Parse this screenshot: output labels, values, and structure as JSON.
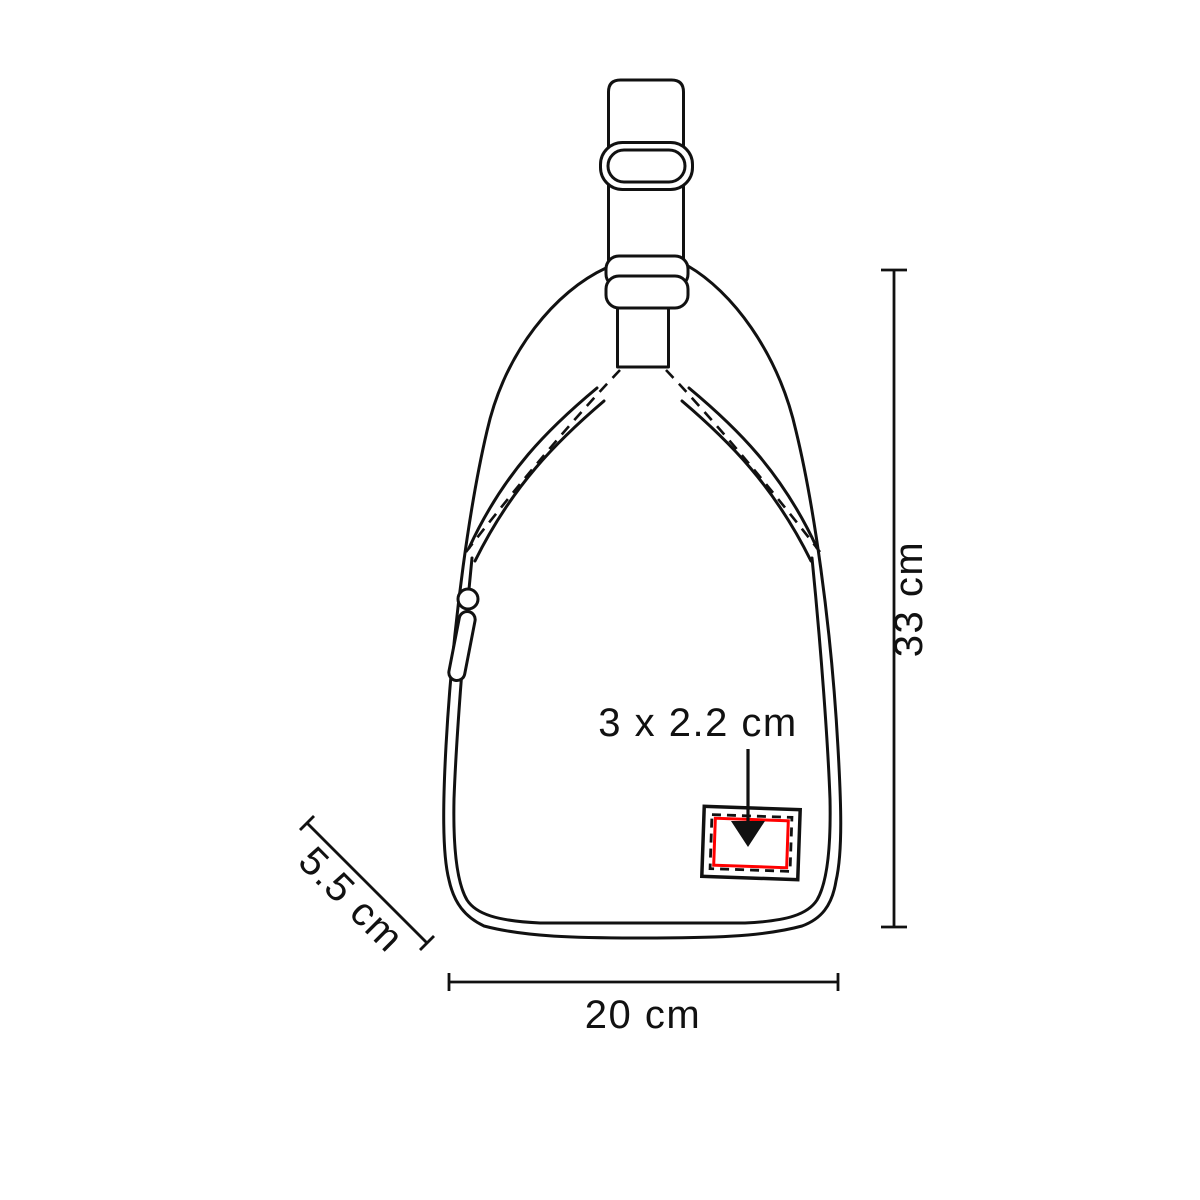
{
  "diagram": {
    "type": "product-dimension-drawing",
    "subject": "sling-bag-front-view",
    "colors": {
      "line": "#111111",
      "imprint_area_red": "#ff0000",
      "background": "#ffffff"
    },
    "annotations": {
      "imprint_size_label": "3 x 2.2 cm",
      "height_label": "33 cm",
      "width_label": "20 cm",
      "depth_label": "5.5 cm"
    }
  }
}
